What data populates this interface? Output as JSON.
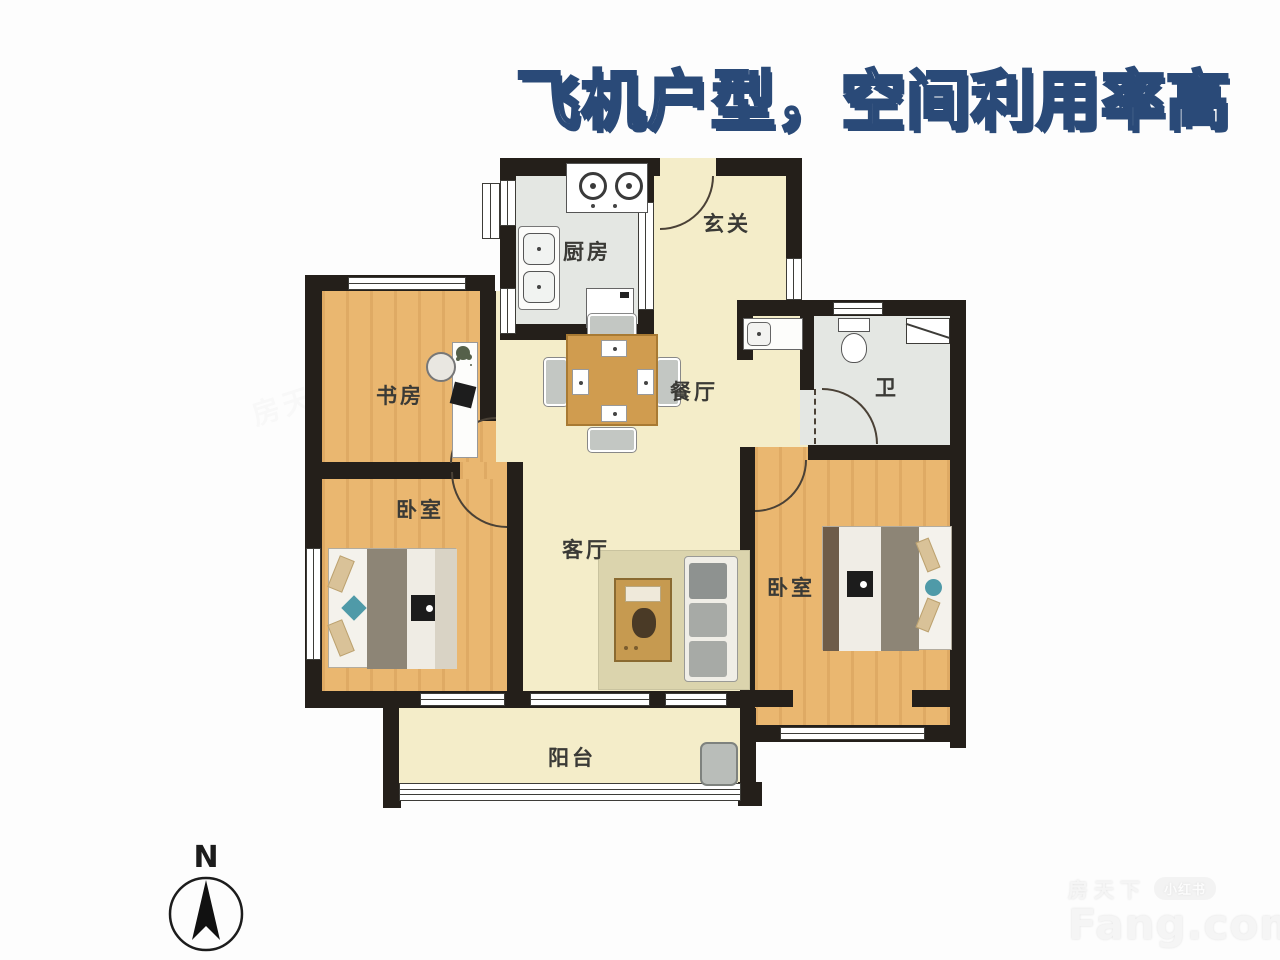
{
  "title": {
    "text": "飞机户型，空间利用率高",
    "fill_color": "#ffffff",
    "outline_color": "#2a4a78"
  },
  "floorplan": {
    "rooms": [
      {
        "id": "kitchen",
        "label": "厨房"
      },
      {
        "id": "entry",
        "label": "玄关"
      },
      {
        "id": "study",
        "label": "书房"
      },
      {
        "id": "dining",
        "label": "餐厅"
      },
      {
        "id": "bath",
        "label": "卫"
      },
      {
        "id": "bedroom-left",
        "label": "卧室"
      },
      {
        "id": "living",
        "label": "客厅"
      },
      {
        "id": "bedroom-right",
        "label": "卧室"
      },
      {
        "id": "balcony",
        "label": "阳台"
      }
    ],
    "colors": {
      "wall": "#241f1a",
      "wood_floor": "#eab770",
      "cream_floor": "#f4edc9",
      "tile_floor": "#e4e7e3",
      "accent_teal": "#4f9aa8"
    }
  },
  "compass": {
    "label": "N"
  },
  "watermark": {
    "brand_cn": "房天下",
    "brand_en": "Fang.com",
    "badge": "小红书"
  }
}
